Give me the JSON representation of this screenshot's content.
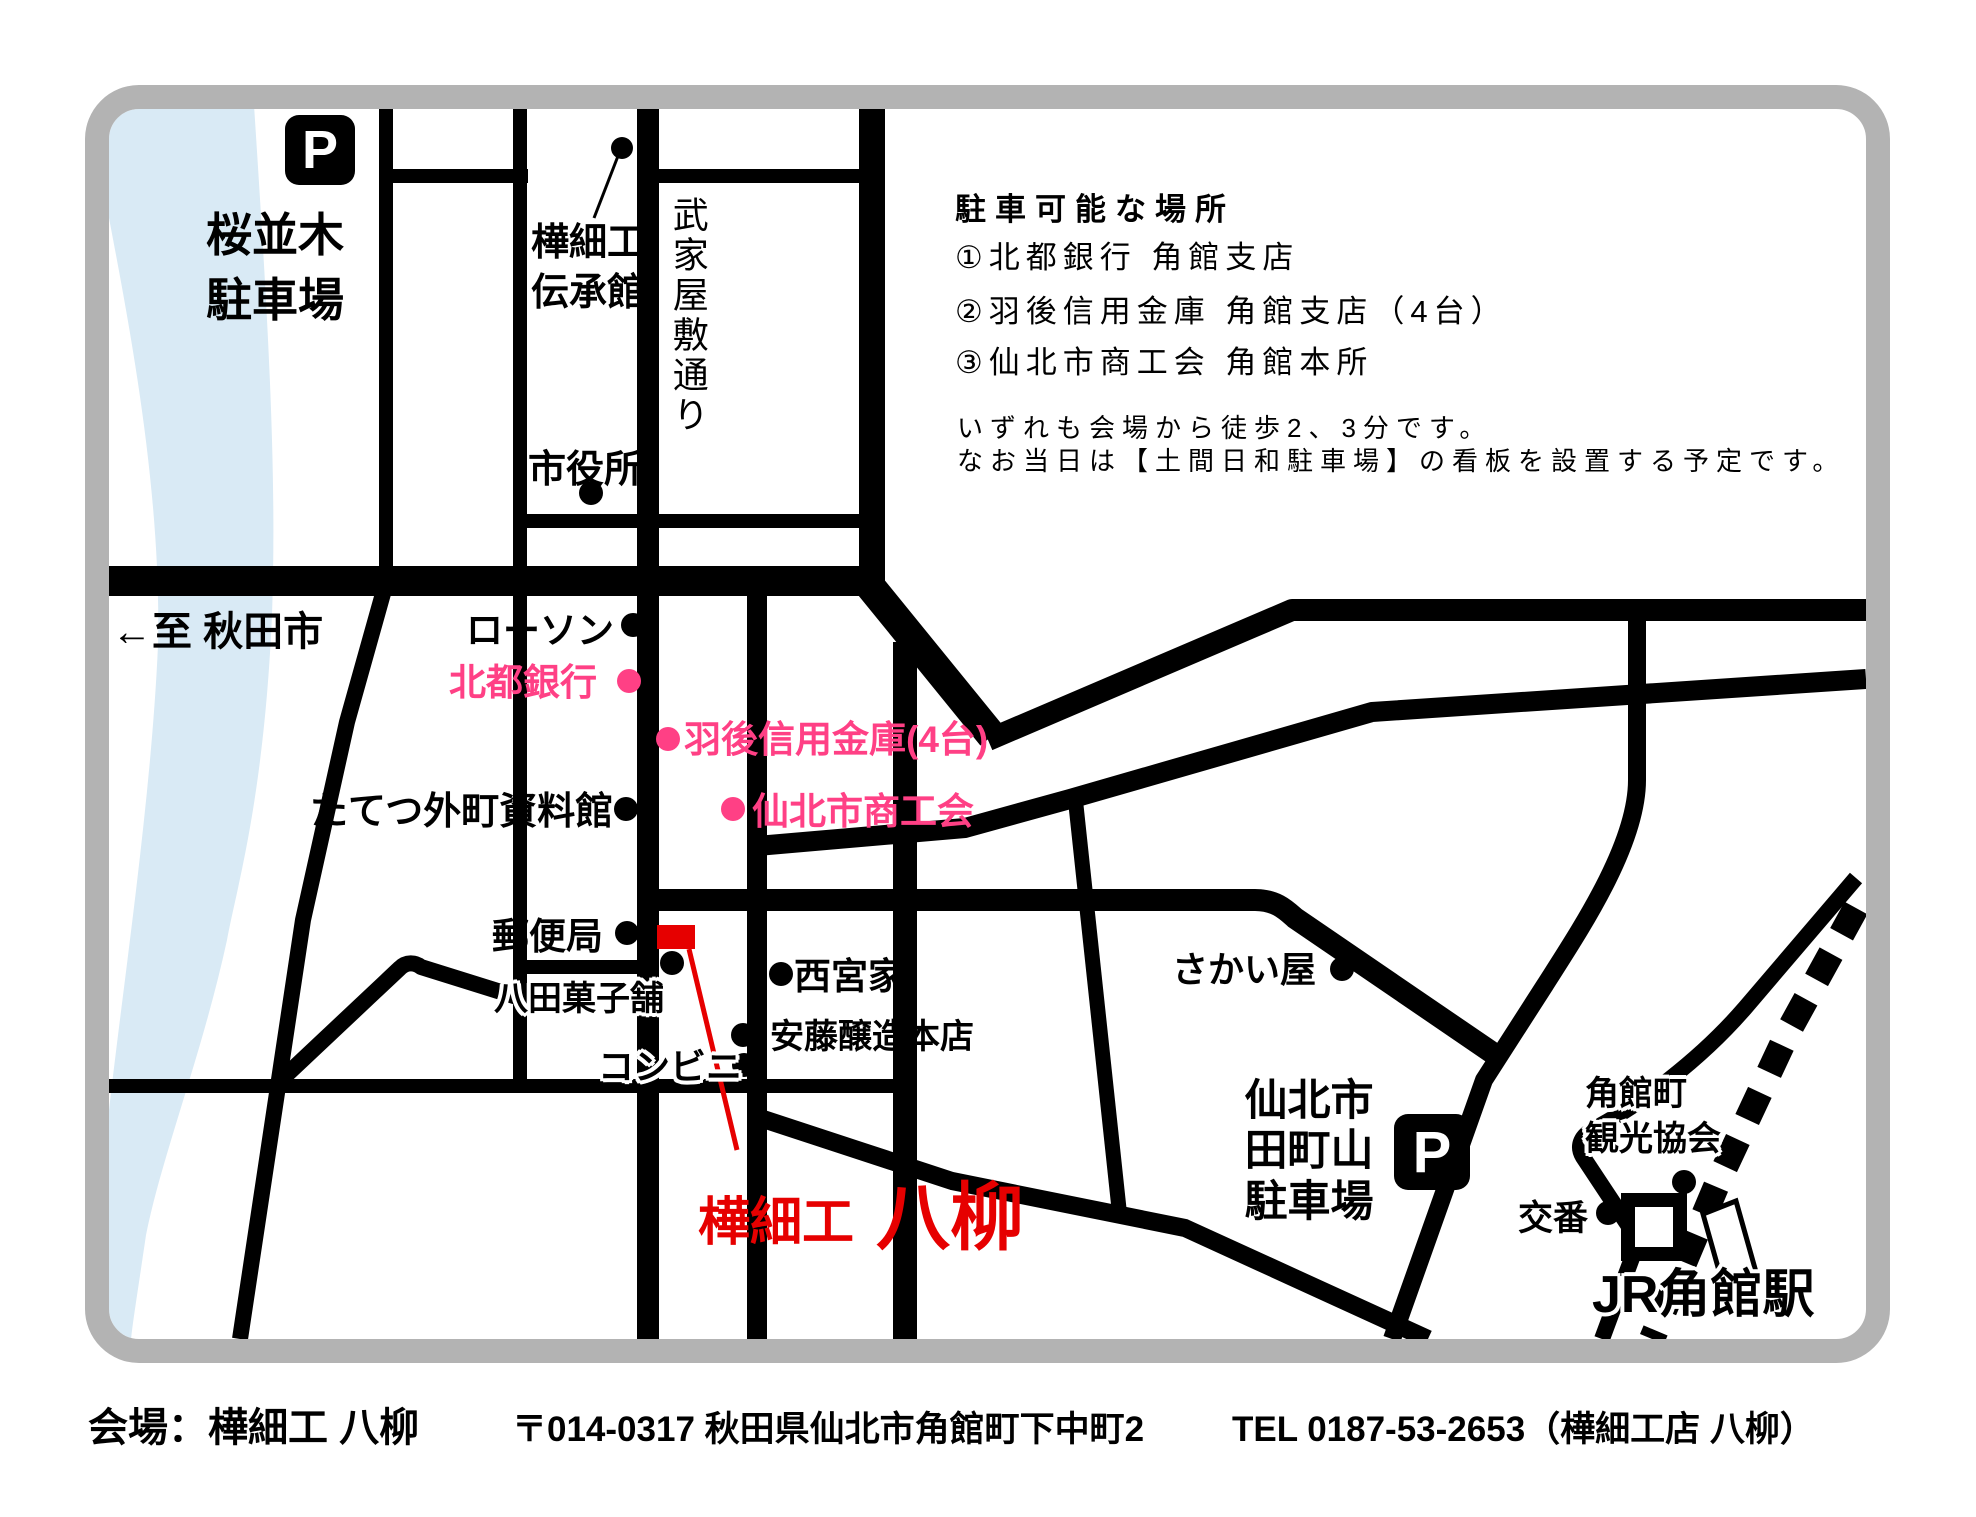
{
  "colors": {
    "border": "#b3b3b3",
    "road": "#000000",
    "river": "#d9eaf5",
    "pink": "#ff4085",
    "red": "#e60000"
  },
  "icons": {
    "parking_letter": "P",
    "marker_dot": "●"
  },
  "labels": {
    "sakura_parking": [
      "桜並木",
      "駐車場"
    ],
    "denshokan": [
      "樺細工",
      "伝承館"
    ],
    "bukeyashiki_street": "武家屋敷通り",
    "city_hall": "市役所",
    "to_akita": "←至 秋田市",
    "lawson": "ローソン",
    "hokuto_bank": "北都銀行",
    "ugo_shinkin": "羽後信用金庫(4台)",
    "shokokai": "仙北市商工会",
    "tatetsu_museum": "たてつ外町資料館",
    "post_office": "郵便局",
    "hatta_kashiho": "八田菓子舗",
    "nishinomiya_house": "西宮家",
    "ando_jozo": "安藤醸造本店",
    "convenience_store": "コンビニ",
    "venue": [
      "樺細工",
      "八柳"
    ],
    "sakaiya": "さかい屋",
    "tamachiyama_parking": [
      "仙北市",
      "田町山",
      "駐車場"
    ],
    "kanko_kyokai": [
      "角館町",
      "観光協会"
    ],
    "koban": "交番",
    "jr_station": "JR角館駅"
  },
  "parking_info": {
    "header": "駐車可能な場所",
    "items": [
      "①北都銀行 角館支店",
      "②羽後信用金庫 角館支店（4台）",
      "③仙北市商工会 角館本所"
    ],
    "notes": [
      "いずれも会場から徒歩2、3分です。",
      "なお当日は【土間日和駐車場】の看板を設置する予定です。"
    ]
  },
  "footer": {
    "venue": "会場：樺細工 八柳",
    "address": "〒014-0317 秋田県仙北市角館町下中町2",
    "tel": "TEL 0187-53-2653（樺細工店 八柳）"
  }
}
